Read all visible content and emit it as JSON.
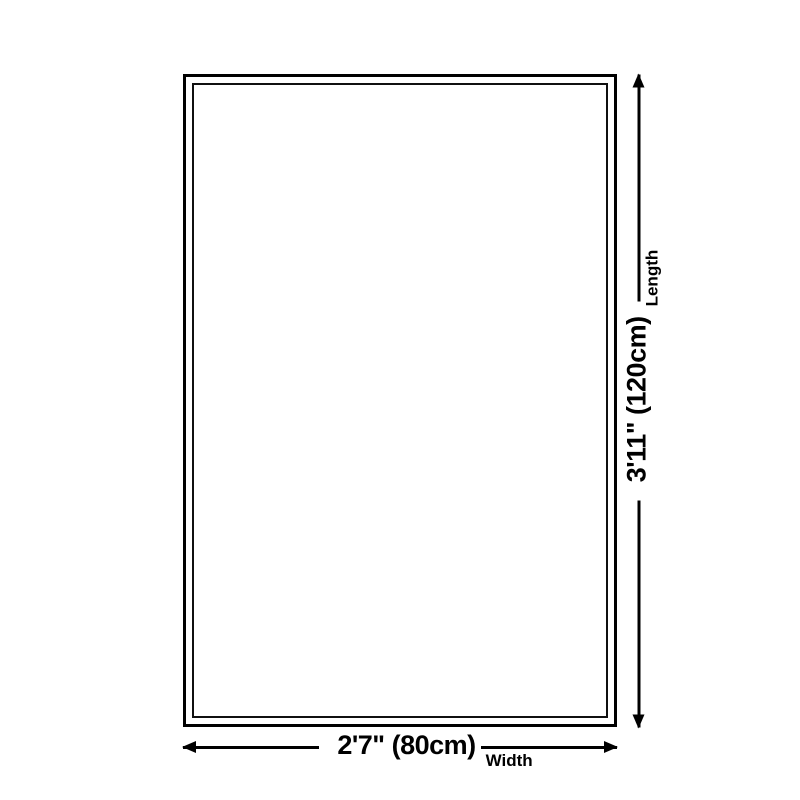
{
  "diagram": {
    "title": "rug-size-diagram",
    "length_annotation": {
      "dimension": "3'11\" (120cm)",
      "label": "Length"
    },
    "width_annotation": {
      "dimension": "2'7\" (80cm)",
      "label": "Width"
    },
    "colors": {
      "ink": "#000000",
      "background": "#ffffff"
    }
  }
}
